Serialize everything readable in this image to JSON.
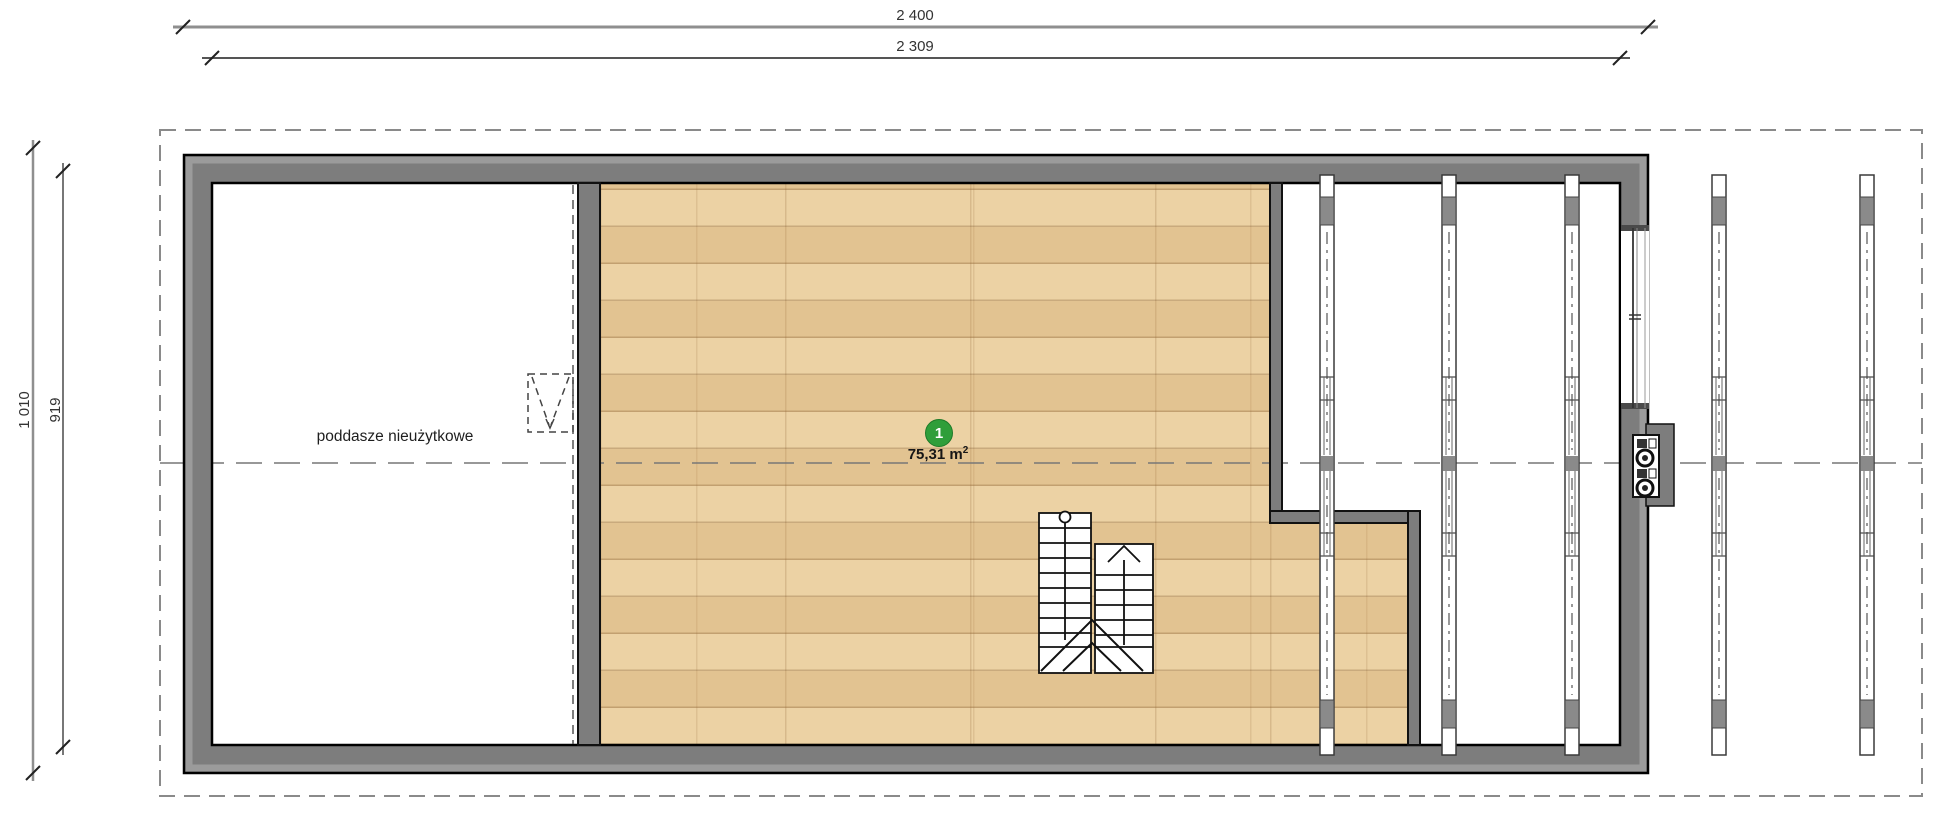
{
  "plan_title": "attic floor plan",
  "dimensions": {
    "top_outer": "2 400",
    "top_inner": "2 309",
    "left_outer": "1 010",
    "left_inner": "919"
  },
  "rooms": {
    "attic_label": "poddasze nieużytkowe",
    "main_number": "1",
    "main_area_base": "75,31 m",
    "main_area_sup": "2"
  },
  "colors": {
    "wall_fill": "#7d7d7d",
    "wall_edge_light": "#9b9b9b",
    "outline": "#000000",
    "wood_floor": "#ecd2a4",
    "wood_line": "#c99c5f",
    "badge_green": "#2f9e3a",
    "dashed_line": "#8a8a8a"
  }
}
